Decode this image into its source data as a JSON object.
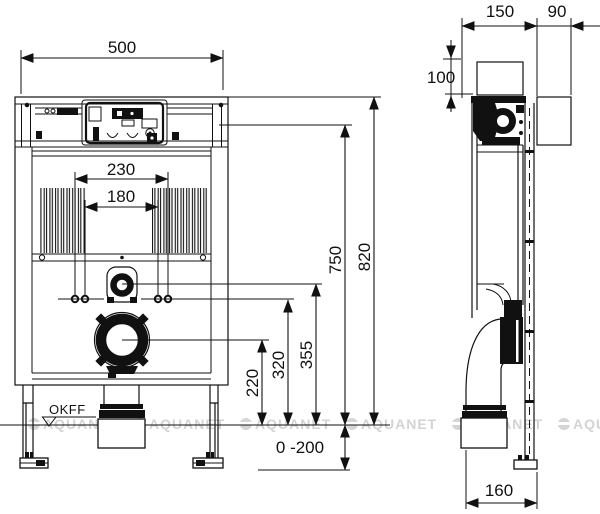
{
  "drawing": {
    "front_view": {
      "floor_label": "OKFF",
      "dims": {
        "overall_width": "500",
        "bolt_spacing_outer": "230",
        "bolt_spacing_inner": "180",
        "waste_outlet_height": "220",
        "bolt_height": "320",
        "flush_pipe_height": "355",
        "cistern_top_height": "750",
        "frame_height": "820",
        "leg_adjust_range": "0 -200"
      }
    },
    "side_view": {
      "dims": {
        "frame_depth": "150",
        "rear_offset": "90",
        "top_offset": "100",
        "outlet_offset": "160"
      }
    },
    "watermark": {
      "text": "AQUANET"
    }
  }
}
